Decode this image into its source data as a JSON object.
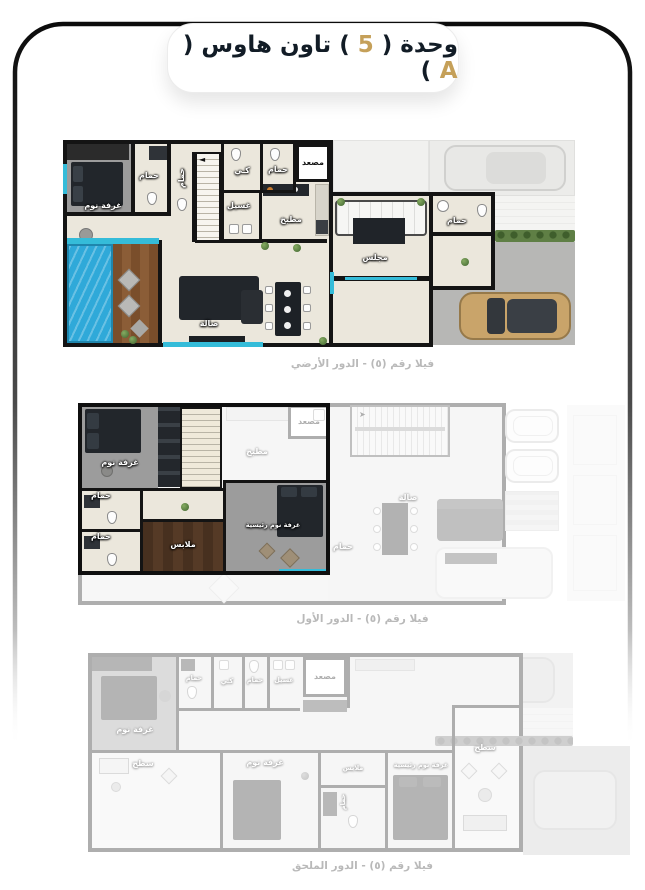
{
  "header": {
    "title_prefix": "وحدة ( ",
    "unit_number": "5",
    "title_middle": " ) تاون هاوس ( ",
    "unit_letter": "A",
    "title_suffix": " )"
  },
  "colors": {
    "accent_gold": "#c5a059",
    "title_navy": "#121c26",
    "wall_black": "#141414",
    "floor_cream": "#ebe7dc",
    "pool_blue": "#2fa9d9",
    "window_cyan": "#35bcd9",
    "caption_gray": "#b9b9b9"
  },
  "icons": {
    "stair_arrow_ground": "◄",
    "stair_arrow_first": "➤"
  },
  "floors": [
    {
      "id": "ground-floor",
      "caption": "فيلا رقم (٥) - الدور الأرضي",
      "rooms": {
        "bedroom": "غرفة نوم",
        "bath_a": "حمام",
        "bath_b": "حمام",
        "ironing": "كـي",
        "bath_c": "حمام",
        "elevator": "مصعد",
        "laundry": "غسيل",
        "kitchen": "مطبخ",
        "majlis": "مجلس",
        "bath_d": "حمام",
        "hall": "صالة"
      }
    },
    {
      "id": "first-floor",
      "caption": "فيلا رقم (٥) - الدور الأول",
      "rooms": {
        "bedroom": "غرفة نوم",
        "bath_a": "حمام",
        "bath_b": "حمام",
        "dressing": "ملابس",
        "master_bedroom": "غرفة نوم رئيسية",
        "kitchen": "مطبخ",
        "elevator": "مصعد",
        "hall": "صالة",
        "bath_c": "حمام"
      }
    },
    {
      "id": "annex-floor",
      "caption": "فيلا رقم (٥) - الدور الملحق",
      "rooms": {
        "bedroom": "غرفة نوم",
        "bath_a": "حمام",
        "ironing": "كـي",
        "bath_b": "حمام",
        "laundry": "غسيل",
        "elevator": "مصعد",
        "terrace_a": "سطح",
        "bedroom2": "غرفة نوم",
        "dressing": "ملابس",
        "bath_c": "حمام",
        "master_bedroom": "غرفة نوم رئيسية",
        "terrace_b": "سطح"
      }
    }
  ]
}
